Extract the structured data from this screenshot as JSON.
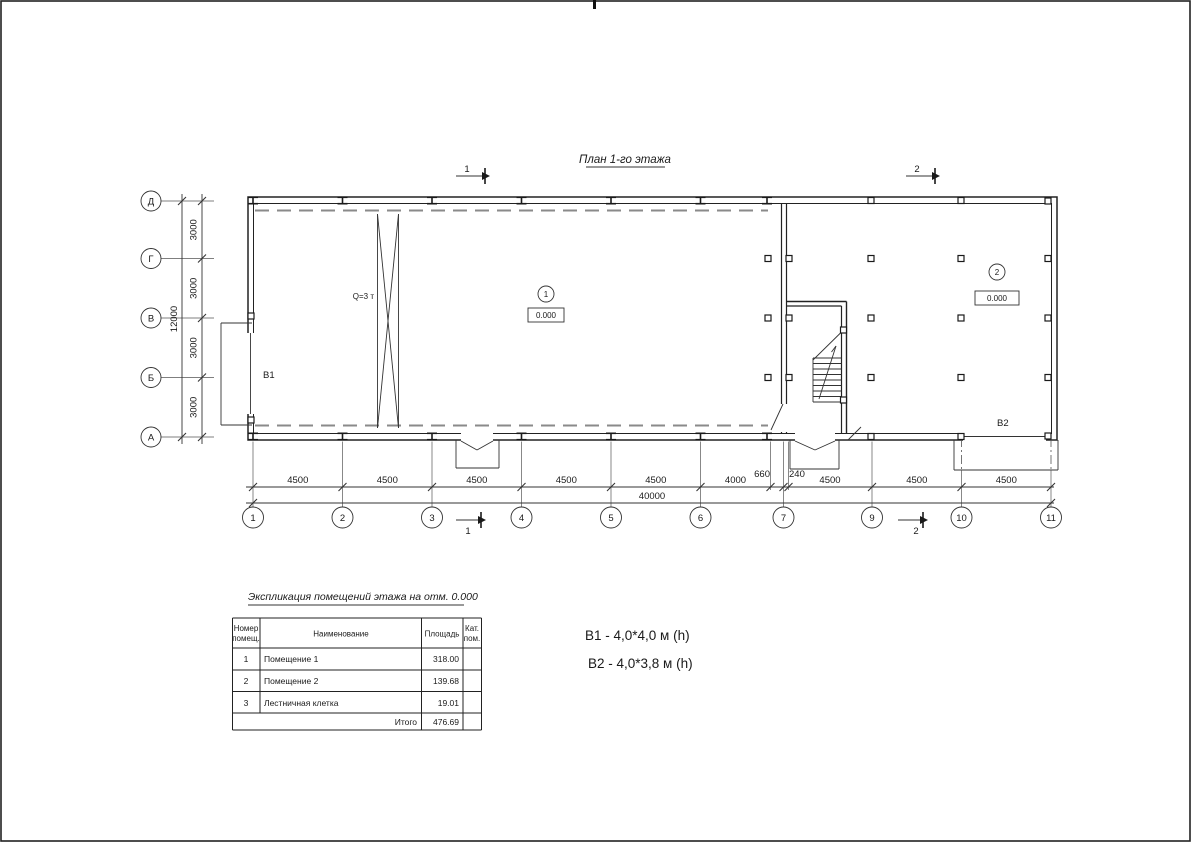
{
  "drawing_title": "План 1-го этажа",
  "plan": {
    "axes_left": [
      "Д",
      "Г",
      "В",
      "Б",
      "А"
    ],
    "axes_bottom": [
      "1",
      "2",
      "3",
      "4",
      "5",
      "6",
      "7",
      "9",
      "10",
      "11"
    ],
    "dims_left": [
      "3000",
      "3000",
      "3000",
      "3000"
    ],
    "dim_totals": {
      "width": "40000",
      "height": "12000"
    },
    "dims_bottom": [
      "4500",
      "4500",
      "4500",
      "4500",
      "4500",
      "4000",
      "660",
      "240",
      "4500",
      "4500",
      "4500"
    ],
    "sections": {
      "one": "1",
      "two": "2"
    },
    "rooms": [
      {
        "tag": "1",
        "elev": "0.000"
      },
      {
        "tag": "2",
        "elev": "0.000"
      }
    ],
    "labels": {
      "crane": "Q=3 т",
      "gate1": "B1",
      "gate2": "B2"
    }
  },
  "table": {
    "title": "Экспликация помещений этажа на отм. 0.000",
    "headers": {
      "num_l1": "Номер",
      "num_l2": "помещ.",
      "name": "Наименование",
      "area": "Площадь",
      "cat_l1": "Кат.",
      "cat_l2": "пом."
    },
    "rows": [
      {
        "num": "1",
        "name": "Помещение 1",
        "area": "318.00"
      },
      {
        "num": "2",
        "name": "Помещение 2",
        "area": "139.68"
      },
      {
        "num": "3",
        "name": "Лестничная клетка",
        "area": "19.01"
      }
    ],
    "total_label": "Итого",
    "total_value": "476.69"
  },
  "legend": {
    "b1": "B1  -  4,0*4,0 м (h)",
    "b2": "B2 - 4,0*3,8 м (h)"
  }
}
